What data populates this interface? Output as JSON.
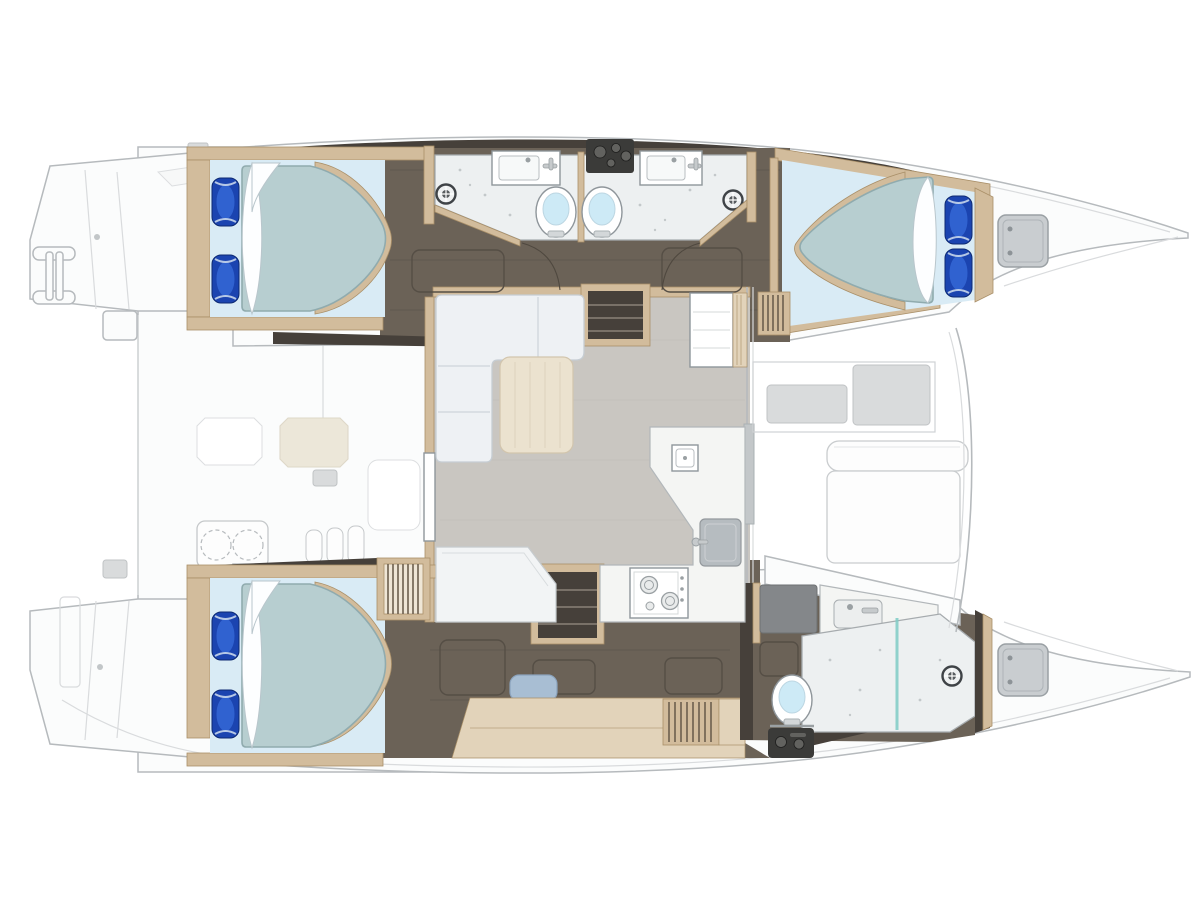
{
  "diagram": {
    "title": "Catamaran yacht interior layout plan (top view)",
    "type": "yacht-floor-plan",
    "view": "overhead"
  },
  "features": {
    "double_cabins": 3,
    "bathrooms": 3,
    "toilets": 3,
    "shower_mixers": 3,
    "salon": "L-shaped sofa with table",
    "galley": "L-shaped counter with sink and two-burner stove",
    "foredeck": "forward cockpit bench and sun pads",
    "aft_deck": "swim platforms, boarding ladder, deck pads"
  },
  "colors": {
    "outline": "#b6babd",
    "faint": "#d9dbdd",
    "deck": "#fbfcfc",
    "dark_floor": "#6b6257",
    "dark_band": "#46403a",
    "wood": "#d2bc9c",
    "wood_dark": "#a98f68",
    "wood_light": "#e2d3ba",
    "bed_base": "#d9ebf5",
    "mattress": "#b7ced0",
    "mattress_edge": "#90abae",
    "pillow": "#1b44b0",
    "pillow_hi": "#3467d6",
    "bath_floor": "#edf0f1",
    "bath_edge": "#a6abae",
    "water": "#cdeaf6",
    "salon_floor": "#c9c6c1",
    "sofa": "#eef1f4",
    "sofa_edge": "#c6cdd3",
    "table": "#ebe2cf",
    "counter": "#f4f5f3",
    "counter_edge": "#b2b7ba",
    "sink_gray": "#b6bcc0",
    "appliance": "#3b3b39",
    "knob": "#62625f",
    "stool": "#a8bed3",
    "pad": "#d9dbdc",
    "glass": "#7fccc6",
    "hatch": "#c9cdd0",
    "cream": "#ece7d9"
  }
}
